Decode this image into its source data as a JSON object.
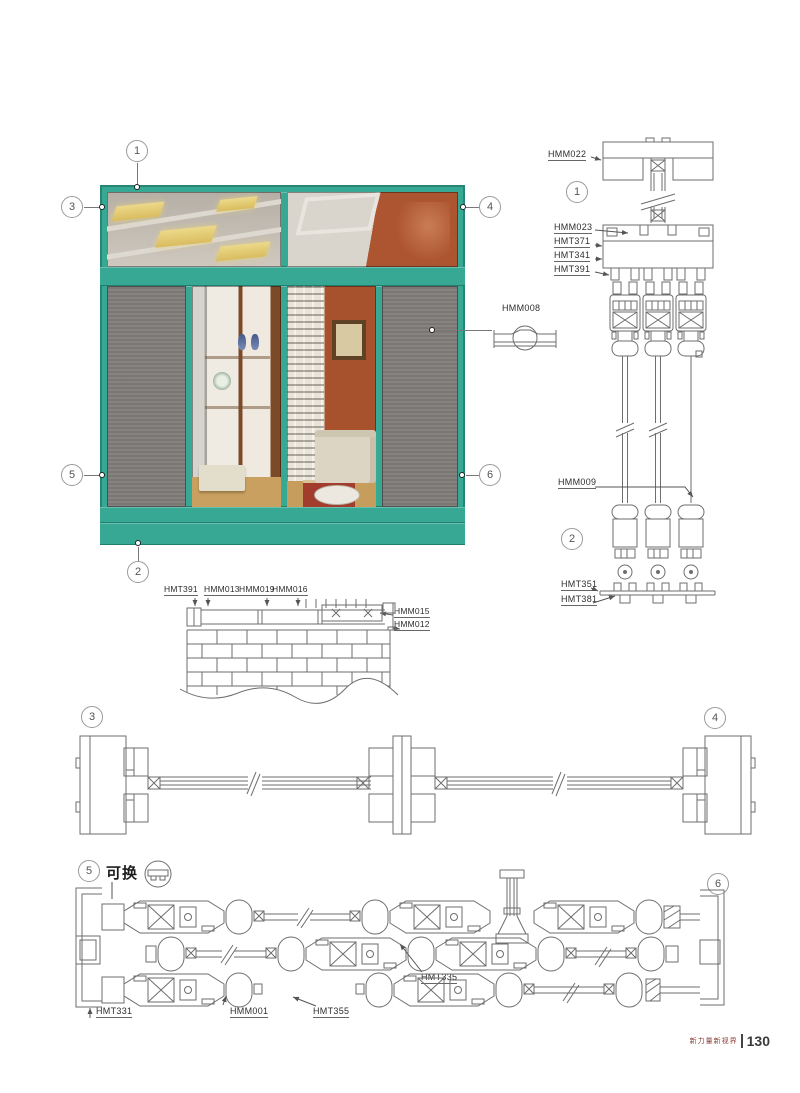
{
  "footer": {
    "slogan": "新力量新视界",
    "divider": "|",
    "page_number": "130"
  },
  "markers": {
    "n1": "1",
    "n2": "2",
    "n3": "3",
    "n4": "4",
    "n5": "5",
    "n6": "6"
  },
  "elevation": {
    "handle_label": "HMM008"
  },
  "vertical_section": {
    "labels": {
      "head": "HMM022",
      "transom_glazing": "HMM023",
      "transom_profile_1": "HMT371",
      "transom_profile_2": "HMT341",
      "track_profile": "HMT391",
      "screen_leaf": "HMM009",
      "bottom_track": "HMT351",
      "track_base": "HMT381"
    }
  },
  "sill_detail": {
    "top_labels": [
      "HMT391",
      "HMM013",
      "HMM019",
      "HMM016"
    ],
    "side_labels": [
      "HMM015",
      "HMM012"
    ]
  },
  "bottom_section": {
    "replaceable_note": "可换",
    "labels": [
      "HMT331",
      "HMM001",
      "HMT355",
      "HMT335"
    ]
  },
  "colors": {
    "frame_teal": "#37a894",
    "frame_teal_dark": "#1e7668",
    "mesh_grey": "#7f7c7a",
    "drawing_line": "#6e6e6e",
    "accent_wall": "#a8512d",
    "footer_red": "#8b3c33"
  }
}
